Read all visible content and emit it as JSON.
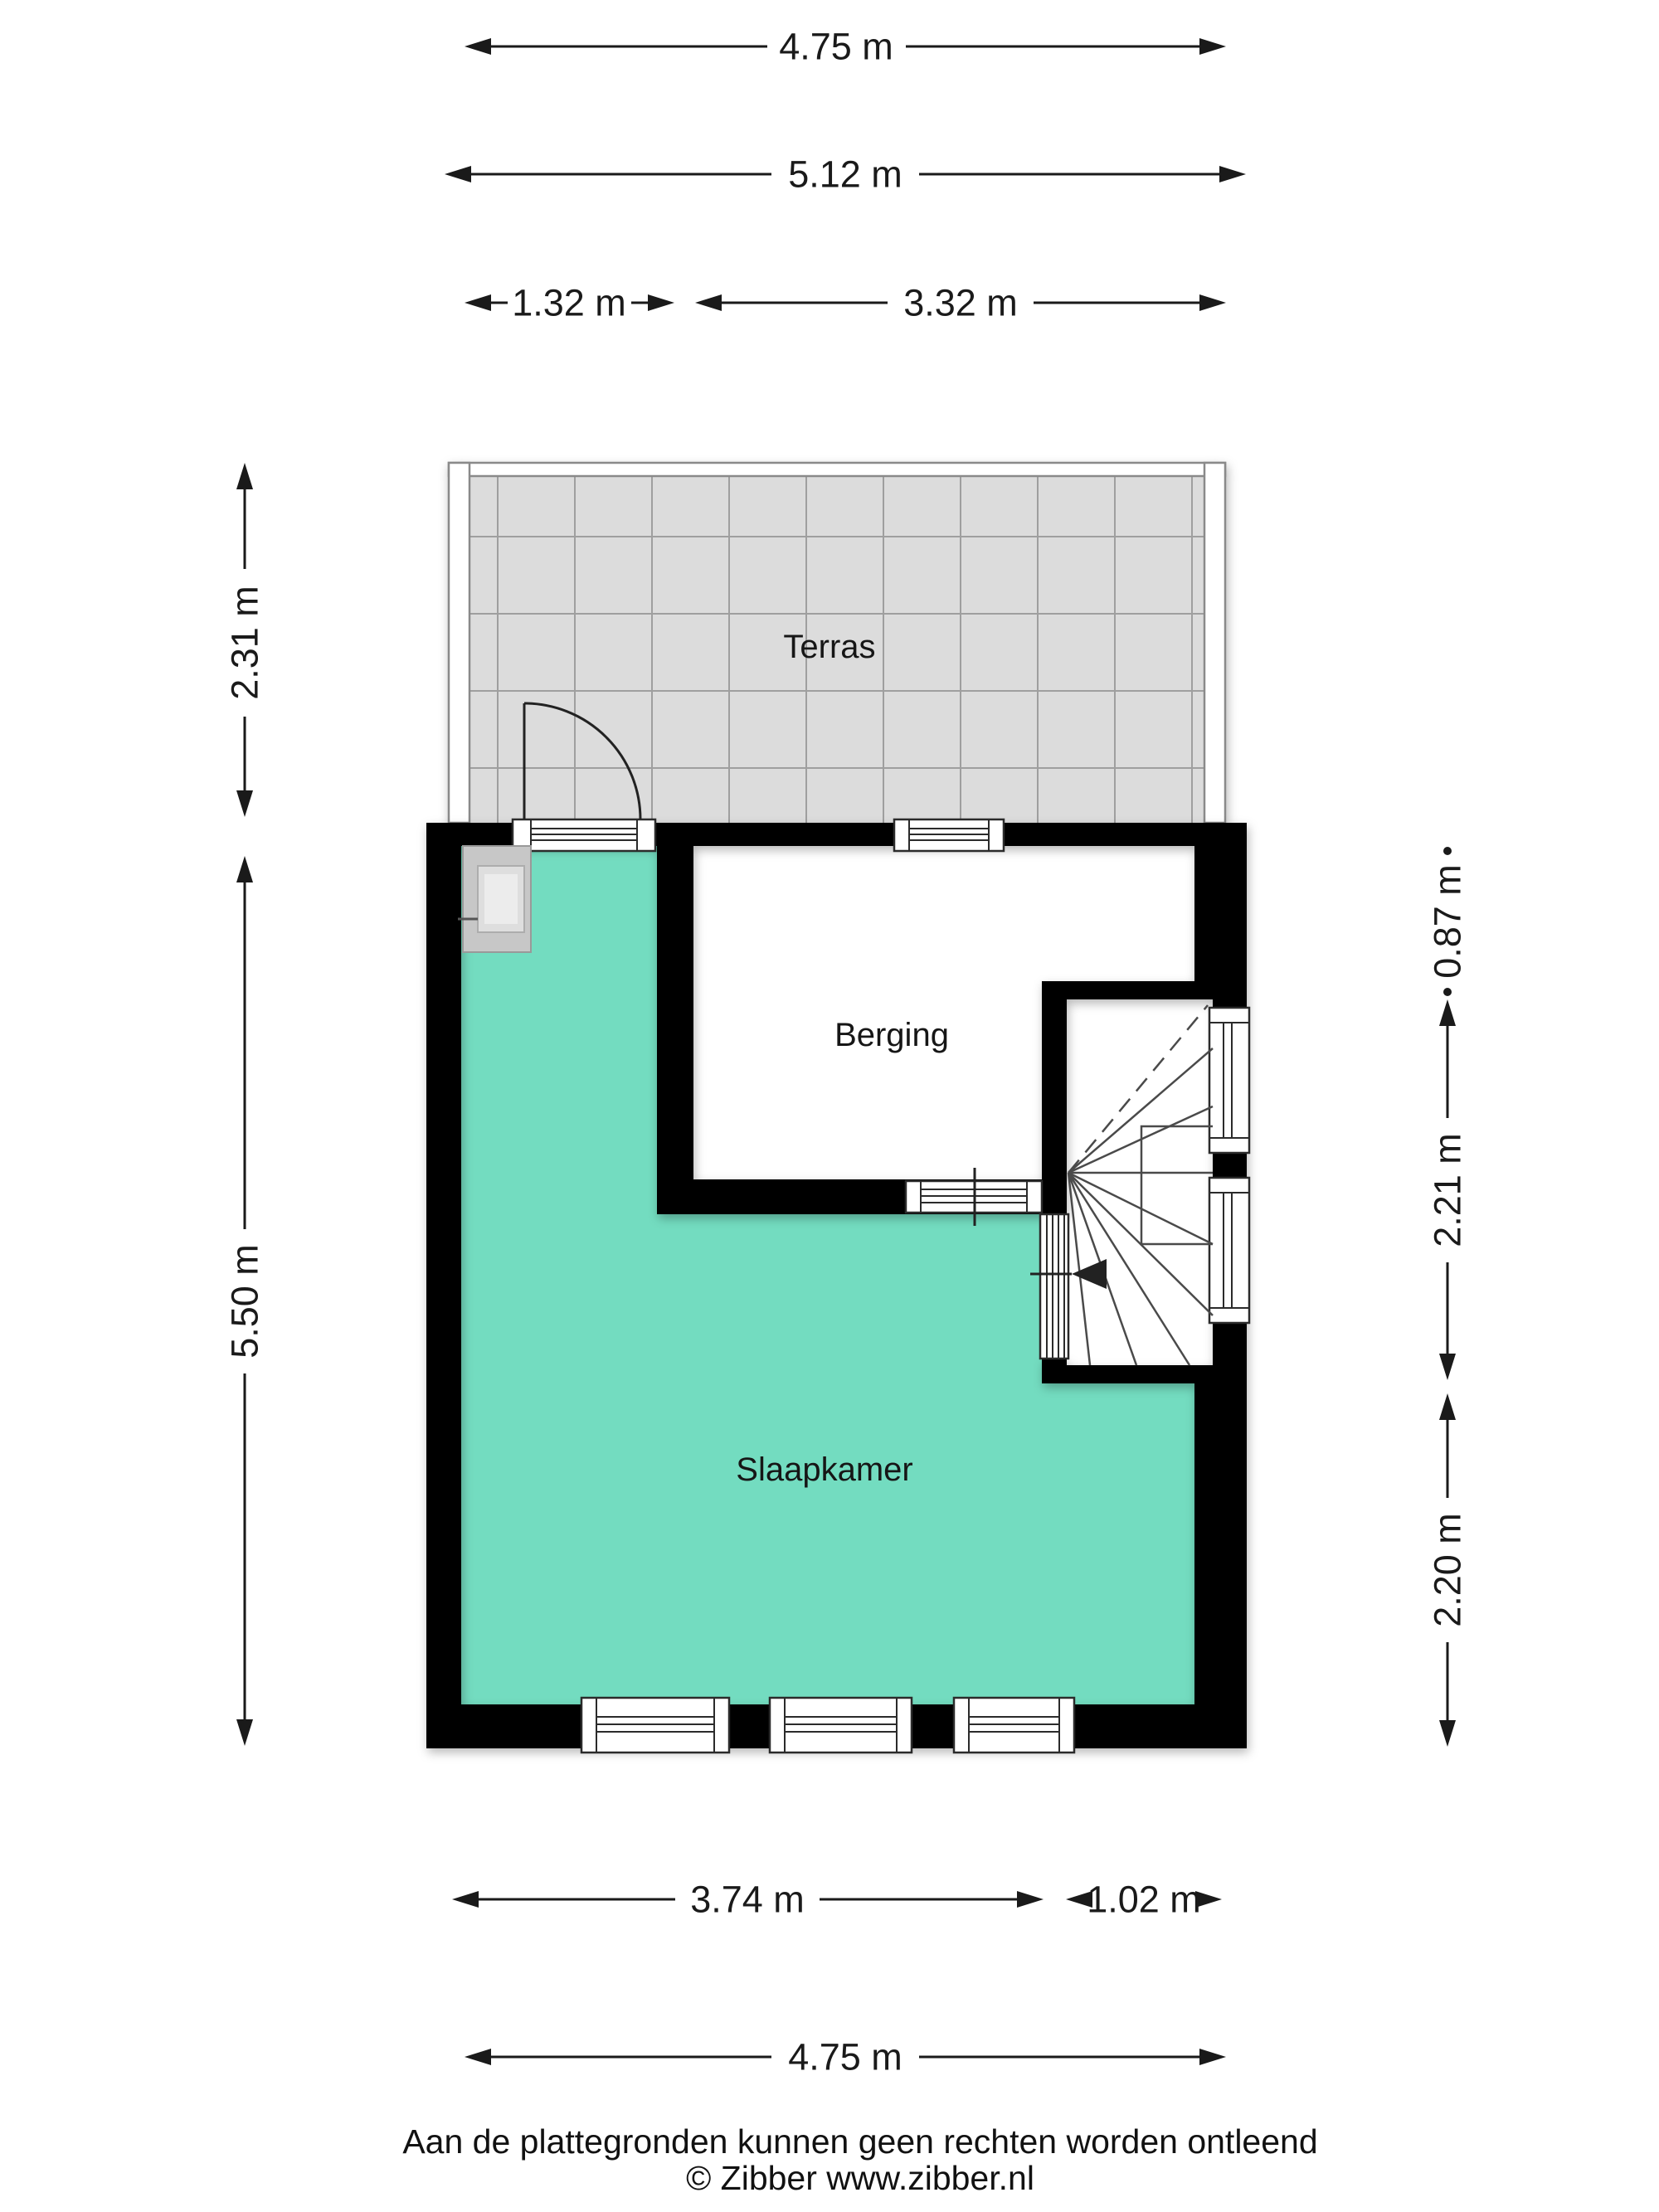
{
  "floorplan": {
    "rooms": {
      "terrace_label": "Terras",
      "storage_label": "Berging",
      "bedroom_label": "Slaapkamer"
    },
    "colors": {
      "bedroom_fill": "#73dcc0",
      "terrace_fill": "#dcdcdc",
      "wall": "#000000"
    },
    "dimensions": {
      "top_width_inner": "4.75 m",
      "top_width_outer": "5.12 m",
      "top_left_segment": "1.32 m",
      "top_right_segment": "3.32 m",
      "left_terrace_depth": "2.31 m",
      "left_building_depth": "5.50 m",
      "right_upper": "0.87 m",
      "right_middle": "2.21 m",
      "right_lower": "2.20 m",
      "bottom_left_segment": "3.74 m",
      "bottom_right_segment": "1.02 m",
      "bottom_width": "4.75 m"
    },
    "footer": {
      "disclaimer": "Aan de plattegronden kunnen geen rechten worden ontleend",
      "copyright": "© Zibber www.zibber.nl"
    }
  }
}
